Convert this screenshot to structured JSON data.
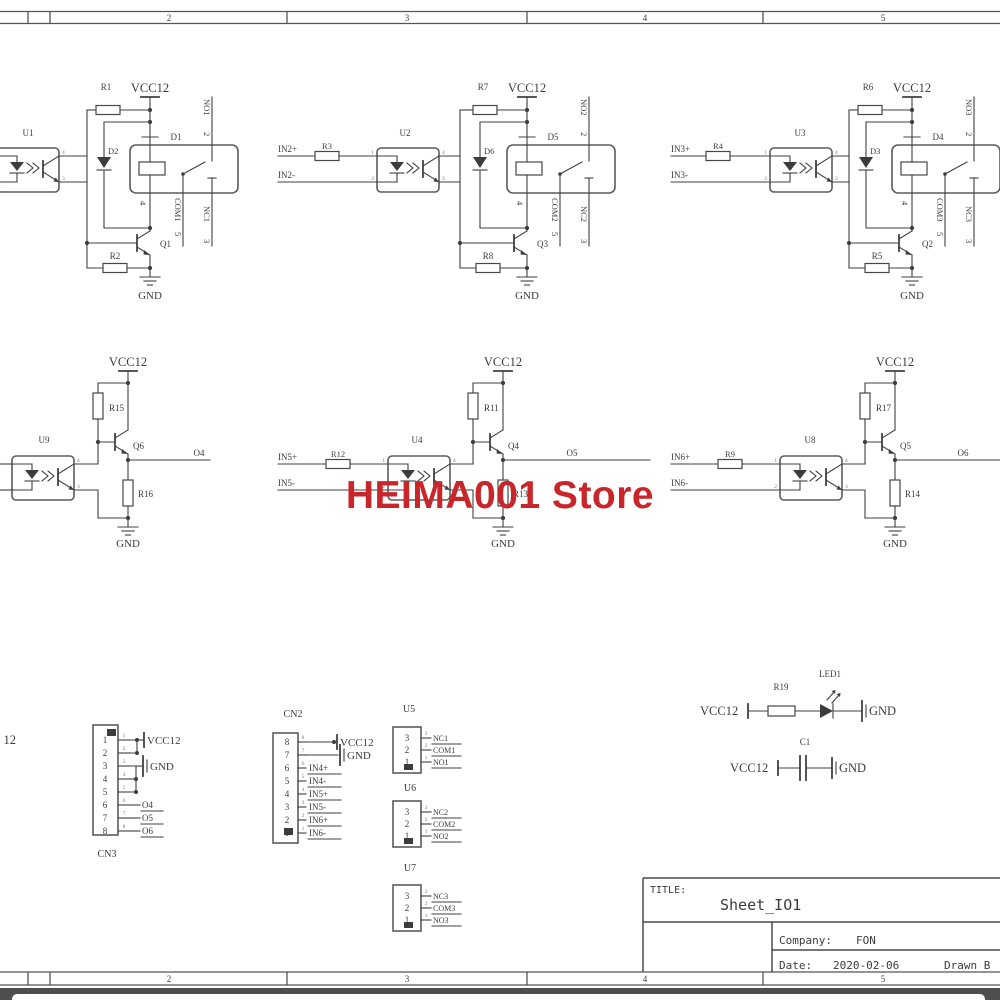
{
  "watermark": {
    "text": "HEIMA001 Store",
    "color": "#c9262b"
  },
  "frame": {
    "top_zones": [
      "2",
      "3",
      "4",
      "5"
    ],
    "bottom_zones": [
      "2",
      "3",
      "4",
      "5"
    ],
    "left_edge_fragment": "12"
  },
  "title_block": {
    "title_label": "TITLE:",
    "title": "Sheet_IO1",
    "company_label": "Company:",
    "company": "FON",
    "date_label": "Date:",
    "date": "2020-02-06",
    "drawn_by_label": "Drawn B"
  },
  "opto_pins": {
    "p1": "1",
    "p2": "2",
    "p3": "3",
    "p4": "4"
  },
  "relay_circuits": [
    {
      "opto": "U1",
      "in_pos": "",
      "in_neg": "",
      "r_in": "",
      "r_pullup": "R1",
      "r_base": "R2",
      "flyback": "D2",
      "relay": "D1",
      "transistor": "Q1",
      "vcc": "VCC12",
      "gnd": "GND",
      "no_label": "NO1",
      "no_pin": "2",
      "com_label": "COM1",
      "com_pin": "5",
      "nc_label": "NC1",
      "nc_pin": "3",
      "coil_pin": "4"
    },
    {
      "opto": "U2",
      "in_pos": "IN2+",
      "in_neg": "IN2-",
      "r_in": "R3",
      "r_pullup": "R7",
      "r_base": "R8",
      "flyback": "D6",
      "relay": "D5",
      "transistor": "Q3",
      "vcc": "VCC12",
      "gnd": "GND",
      "no_label": "NO2",
      "no_pin": "2",
      "com_label": "COM2",
      "com_pin": "5",
      "nc_label": "NC2",
      "nc_pin": "3",
      "coil_pin": "4"
    },
    {
      "opto": "U3",
      "in_pos": "IN3+",
      "in_neg": "IN3-",
      "r_in": "R4",
      "r_pullup": "R6",
      "r_base": "R5",
      "flyback": "D3",
      "relay": "D4",
      "transistor": "Q2",
      "vcc": "VCC12",
      "gnd": "GND",
      "no_label": "NO3",
      "no_pin": "2",
      "com_label": "COM3",
      "com_pin": "5",
      "nc_label": "NC3",
      "nc_pin": "3",
      "coil_pin": "4"
    }
  ],
  "driver_circuits": [
    {
      "opto": "U9",
      "in_pos": "",
      "in_neg": "",
      "r_in": "",
      "r_pullup": "R15",
      "r_emitter": "R16",
      "transistor": "Q6",
      "out": "O4",
      "vcc": "VCC12",
      "gnd": "GND"
    },
    {
      "opto": "U4",
      "in_pos": "IN5+",
      "in_neg": "IN5-",
      "r_in": "R12",
      "r_pullup": "R11",
      "r_emitter": "R13",
      "transistor": "Q4",
      "out": "O5",
      "vcc": "VCC12",
      "gnd": "GND"
    },
    {
      "opto": "U8",
      "in_pos": "IN6+",
      "in_neg": "IN6-",
      "r_in": "R9",
      "r_pullup": "R17",
      "r_emitter": "R14",
      "transistor": "Q5",
      "out": "O6",
      "vcc": "VCC12",
      "gnd": "GND"
    }
  ],
  "connectors": {
    "cn3": {
      "label": "CN3",
      "pins": [
        "1",
        "2",
        "3",
        "4",
        "5",
        "6",
        "7",
        "8"
      ],
      "vcc": "VCC12",
      "gnd": "GND",
      "outputs": [
        "O4",
        "O5",
        "O6"
      ]
    },
    "cn2": {
      "label": "CN2",
      "pins": [
        "8",
        "7",
        "6",
        "5",
        "4",
        "3",
        "2",
        "1"
      ],
      "vcc": "VCC12",
      "gnd": "GND",
      "signals": [
        "IN4+",
        "IN4-",
        "IN5+",
        "IN5-",
        "IN6+",
        "IN6-"
      ]
    },
    "u5": {
      "label": "U5",
      "pins": [
        "3",
        "2",
        "1"
      ],
      "signals": [
        "NC1",
        "COM1",
        "NO1"
      ]
    },
    "u6": {
      "label": "U6",
      "pins": [
        "3",
        "2",
        "1"
      ],
      "signals": [
        "NC2",
        "COM2",
        "NO2"
      ]
    },
    "u7": {
      "label": "U7",
      "pins": [
        "3",
        "2",
        "1"
      ],
      "signals": [
        "NC3",
        "COM3",
        "NO3"
      ]
    }
  },
  "indicator": {
    "vcc": "VCC12",
    "resistor": "R19",
    "led": "LED1",
    "gnd": "GND"
  },
  "decoupling": {
    "vcc": "VCC12",
    "cap": "C1",
    "gnd": "GND"
  }
}
